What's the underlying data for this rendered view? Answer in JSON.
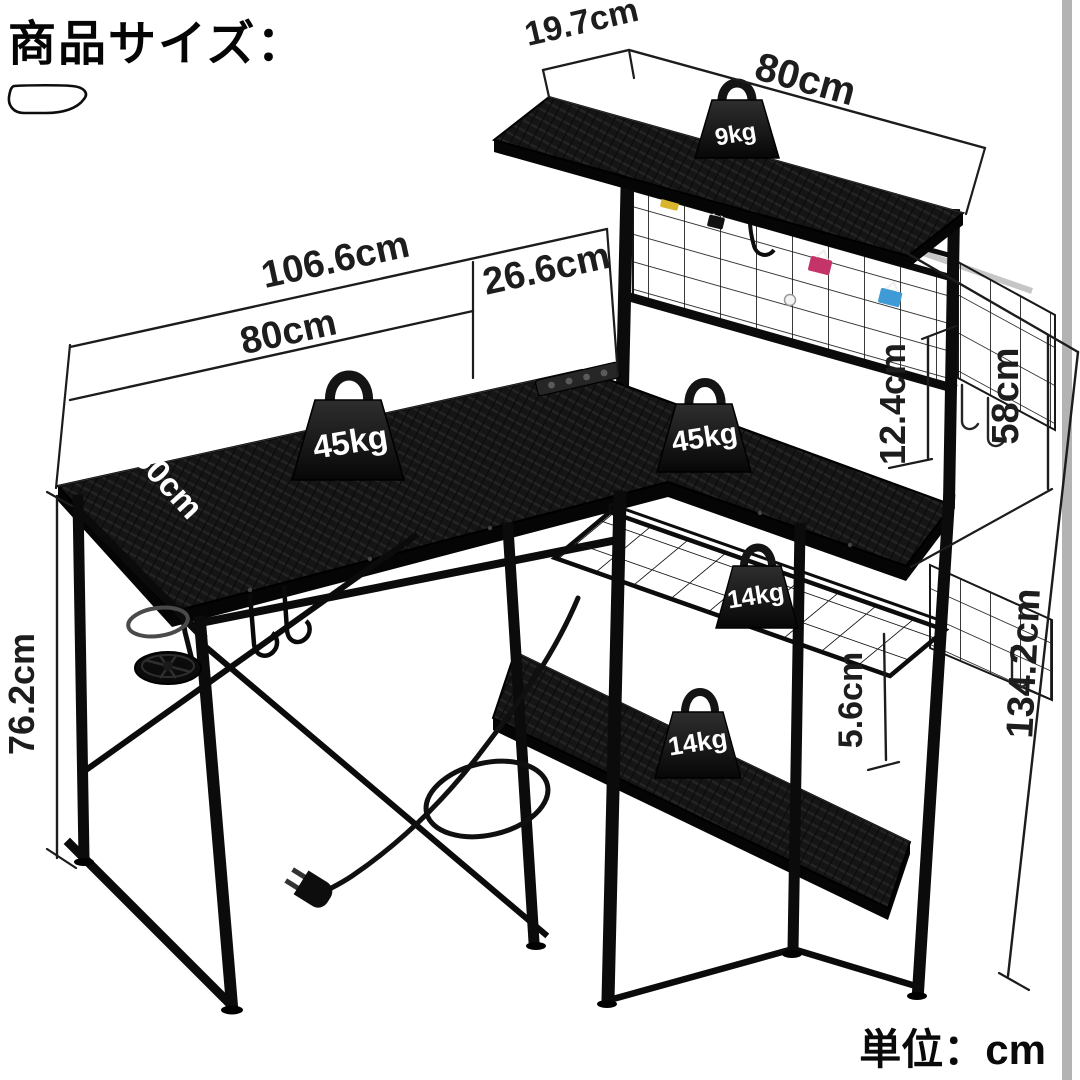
{
  "header": {
    "title": "商品サイズ："
  },
  "footer": {
    "unit_note": "単位：cm"
  },
  "product": {
    "dimensions": {
      "top_shelf_depth": "19.7cm",
      "top_shelf_length": "80cm",
      "total_width": "106.6cm",
      "main_desk_width": "80cm",
      "return_width": "26.6cm",
      "desk_depth": "50cm",
      "hutch_clearance": "12.4cm",
      "hutch_height": "58cm",
      "desk_height": "76.2cm",
      "total_height": "134.2cm",
      "shelf_gap": "5.6cm"
    },
    "load_capacity": {
      "top_shelf": "9kg",
      "main_desk": "45kg",
      "side_desk": "45kg",
      "wire_shelf": "14kg",
      "bottom_shelf": "14kg"
    }
  },
  "colors": {
    "ink": "#1c1c1c",
    "desk_fill": "#141414",
    "silver_rail": "#c6c6c6",
    "grey_bar": "#b3b3b3",
    "clip_yellow": "#d9b52e",
    "clip_red": "#c53468",
    "clip_blue": "#3e9bd6"
  }
}
